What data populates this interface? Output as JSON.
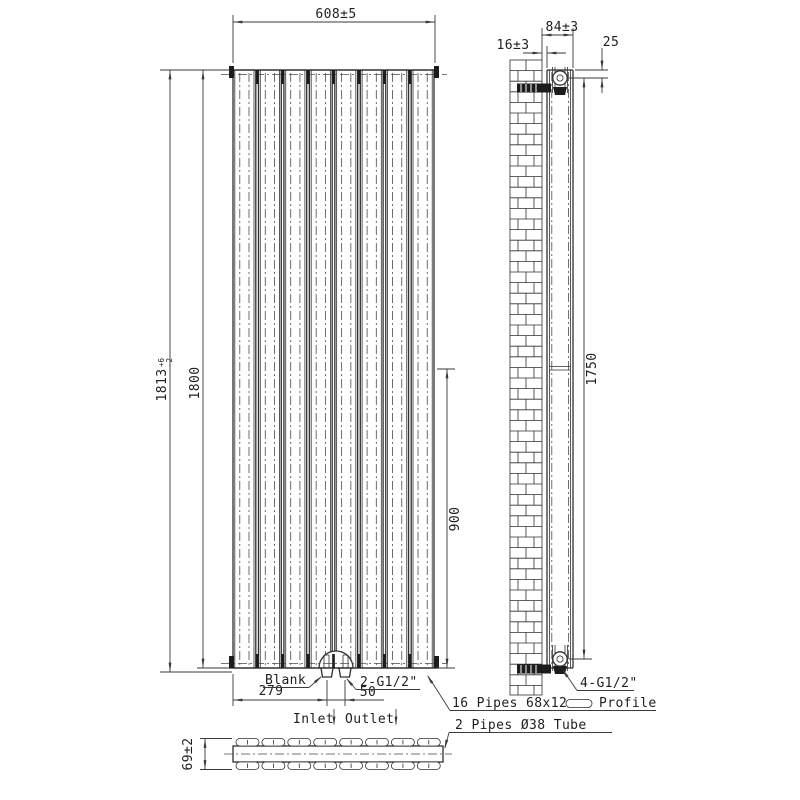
{
  "colors": {
    "line": "#2f2f2f",
    "dim_line": "#3a3a3a",
    "dark_fill": "#1c1c1c",
    "background": "#ffffff"
  },
  "front_view": {
    "width_dim": "608±5",
    "overall_height": {
      "value": "1813",
      "tol_upper": "+6",
      "tol_lower": "-2"
    },
    "height_dim": "1800",
    "half_height_dim": "900",
    "panel_count": 8,
    "bottom": {
      "blank_label": "Blank",
      "left_offset_dim": "279",
      "valve_spacing_dim": "50",
      "valve_thread_label": "2-G1/2\"",
      "inlet_label": "Inlet",
      "outlet_label": "Outlet"
    }
  },
  "side_view": {
    "wall_gap_dim": "16±3",
    "depth_dim": "84±3",
    "bracket_top_offset_dim": "25",
    "bracket_spacing_dim": "1750",
    "bracket_thread_label": "4-G1/2\""
  },
  "section_view": {
    "height_dim": "69±2",
    "pipes_per_row": 8
  },
  "notes": {
    "pipes_note": "16 Pipes 68x12",
    "profile_label": "Profile",
    "tube_note": "2 Pipes Ø38 Tube"
  }
}
